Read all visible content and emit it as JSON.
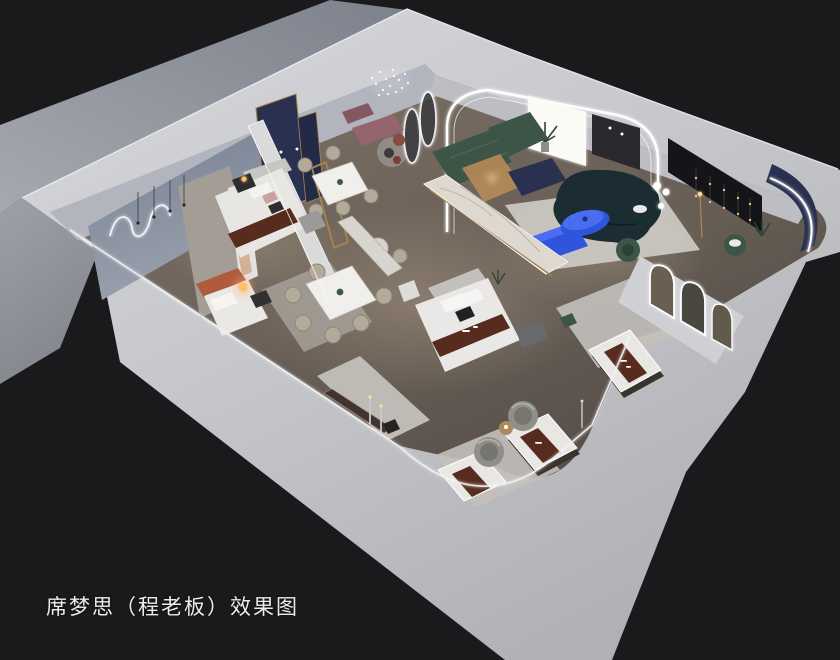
{
  "caption": {
    "text": "席梦思（程老板）效果图"
  },
  "palette": {
    "background": "#1a1a1d",
    "ground": "#8d929b",
    "building_shell": "#c7c8cc",
    "floor_wood": "#6e645b",
    "rug_light": "#c3c0bb",
    "accent_cobalt": "#2f55dd",
    "accent_cobalt_light": "#4a6cf0",
    "accent_teal": "#1b2d33",
    "accent_green": "#3d5546",
    "accent_navy": "#2a3150",
    "accent_maroon": "#572b1e",
    "accent_mauve": "#95656d",
    "accent_rust": "#b05a3e",
    "accent_gold": "#a9834f",
    "led": "#ffffff",
    "lamp_warm": "#ffc069",
    "marble": "#ddd8d0"
  },
  "scene": {
    "kind": "3d-axonometric-interior-render",
    "subject": "mattress showroom cutaway with bedrooms, dining sets and living area"
  }
}
